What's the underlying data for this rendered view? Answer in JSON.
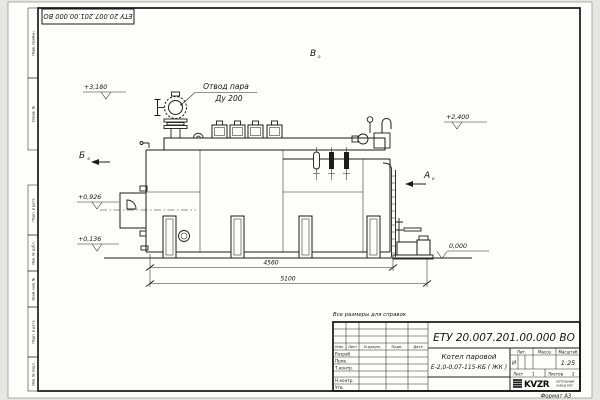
{
  "frame": {
    "top_stamp": "ЕТУ 20.007.201.00.000  ВО",
    "format_label": "Формат А3",
    "reference_note": "Все размеры для справок",
    "side_strip": [
      "Перв. примен.",
      "Справ. №",
      "Подп. и дата",
      "Инв. № дубл.",
      "Взам. инв. №",
      "Подп. и дата",
      "Инв. № подл."
    ]
  },
  "drawing": {
    "callout": {
      "line1": "Отвод пара",
      "line2": "Ду 200"
    },
    "views": {
      "a": "А",
      "b": "Б",
      "v": "В",
      "suffix": "o"
    },
    "levels": {
      "l3180": "+3,180",
      "l2400": "+2,400",
      "l0926": "+0,926",
      "l0136": "+0,136",
      "l0000": "0,000"
    },
    "dims": {
      "d4560": "4560",
      "d5100": "5100"
    }
  },
  "title_block": {
    "doc_number": "ЕТУ 20.007.201.00.000  ВО",
    "product_name_line1": "Котел паровой",
    "product_name_line2": "Е-2,0-0,07-115-КБ ( ЖК )",
    "lit_value": "И",
    "scale_value": "1:25",
    "sheet_label": "Лист",
    "sheet_no": "1",
    "sheets_label": "Листов",
    "sheets_total": "2",
    "col_headers": {
      "izm": "Изм.",
      "list": "Лист",
      "ndoc": "N докум.",
      "podp": "Подп.",
      "data": "Дата"
    },
    "small_headers": {
      "lit": "Лит.",
      "mass": "Масса",
      "scale": "Масштаб"
    },
    "roles": [
      "Разраб.",
      "Пров.",
      "Т.контр.",
      "Н.контр.",
      "Утв."
    ],
    "company": {
      "logo_text": "KVZR",
      "line1": "КОТЕЛЬНЫЙ",
      "line2": "ЗАВОД РЭП"
    }
  }
}
